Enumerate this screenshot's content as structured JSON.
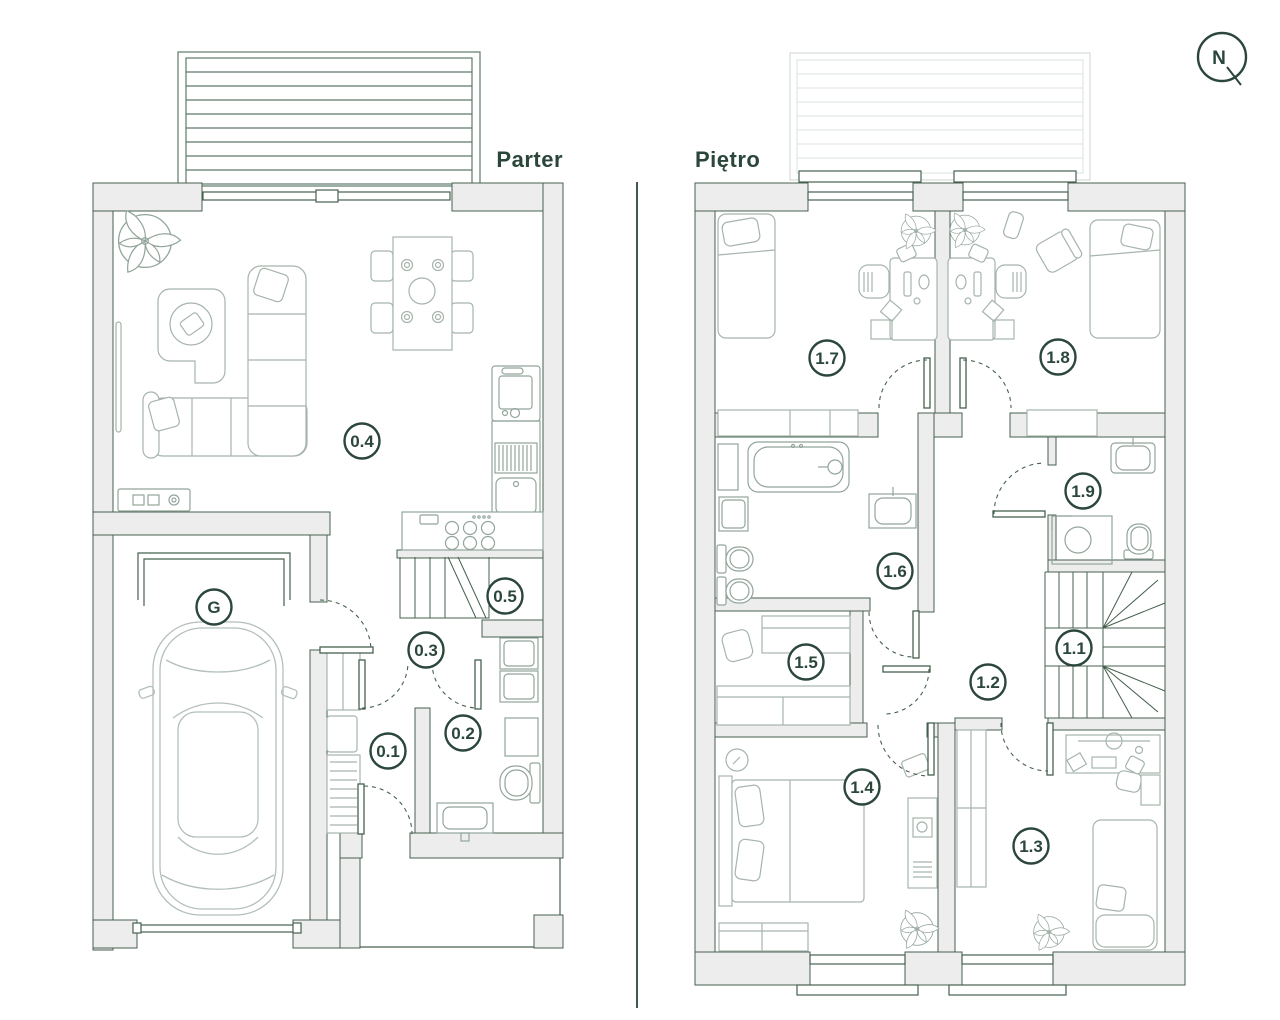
{
  "compass_label": "N",
  "colors": {
    "accent": "#2b463a",
    "wall_line": "#46604f",
    "wall_fill": "#ededed",
    "furniture_line": "#a6b4ac",
    "deck_line": "#5d7a6a"
  },
  "parter": {
    "title": "Parter",
    "rooms": {
      "r01": "0.1",
      "r02": "0.2",
      "r03": "0.3",
      "r04": "0.4",
      "r05": "0.5",
      "garage": "G"
    }
  },
  "pietro": {
    "title": "Piętro",
    "rooms": {
      "r11": "1.1",
      "r12": "1.2",
      "r13": "1.3",
      "r14": "1.4",
      "r15": "1.5",
      "r16": "1.6",
      "r17": "1.7",
      "r18": "1.8",
      "r19": "1.9"
    }
  }
}
